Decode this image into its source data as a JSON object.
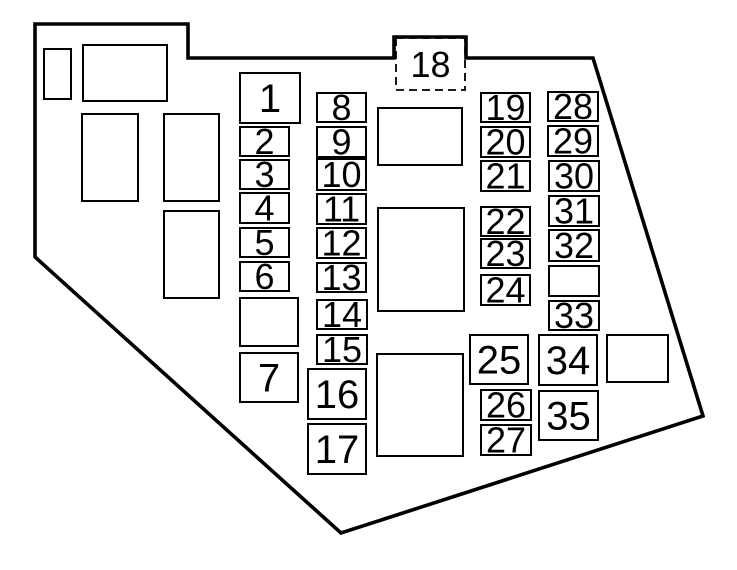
{
  "diagram": {
    "kind": "fuse-box-layout",
    "background": "#ffffff",
    "line_color": "#000000",
    "outline_path": "M35,24 L188,24 L188,58 L394,58 L394,37 L466,37 L466,58 L593,58 L703,416 L341,533 L35,257 Z",
    "dashed_fuse": {
      "label": "18",
      "x": 396,
      "y": 38,
      "w": 69,
      "h": 52
    },
    "fuses": [
      {
        "label": "1",
        "x": 240,
        "y": 73,
        "w": 60,
        "h": 50,
        "big": true
      },
      {
        "label": "2",
        "x": 240,
        "y": 127,
        "w": 49,
        "h": 29,
        "big": false
      },
      {
        "label": "3",
        "x": 240,
        "y": 160,
        "w": 49,
        "h": 29,
        "big": false
      },
      {
        "label": "4",
        "x": 240,
        "y": 193,
        "w": 49,
        "h": 30,
        "big": false
      },
      {
        "label": "5",
        "x": 240,
        "y": 228,
        "w": 49,
        "h": 29,
        "big": false
      },
      {
        "label": "6",
        "x": 240,
        "y": 262,
        "w": 49,
        "h": 29,
        "big": false
      },
      {
        "label": "7",
        "x": 240,
        "y": 353,
        "w": 58,
        "h": 49,
        "big": true
      },
      {
        "label": "8",
        "x": 317,
        "y": 93,
        "w": 49,
        "h": 29,
        "big": false
      },
      {
        "label": "9",
        "x": 317,
        "y": 127,
        "w": 49,
        "h": 30,
        "big": false
      },
      {
        "label": "10",
        "x": 317,
        "y": 159,
        "w": 49,
        "h": 31,
        "big": false
      },
      {
        "label": "11",
        "x": 317,
        "y": 194,
        "w": 49,
        "h": 30,
        "big": false
      },
      {
        "label": "12",
        "x": 317,
        "y": 228,
        "w": 49,
        "h": 30,
        "big": false
      },
      {
        "label": "13",
        "x": 317,
        "y": 263,
        "w": 49,
        "h": 29,
        "big": false
      },
      {
        "label": "14",
        "x": 317,
        "y": 300,
        "w": 50,
        "h": 29,
        "big": false
      },
      {
        "label": "15",
        "x": 317,
        "y": 335,
        "w": 50,
        "h": 29,
        "big": false
      },
      {
        "label": "16",
        "x": 308,
        "y": 369,
        "w": 58,
        "h": 50,
        "big": true
      },
      {
        "label": "17",
        "x": 308,
        "y": 424,
        "w": 58,
        "h": 50,
        "big": true
      },
      {
        "label": "19",
        "x": 481,
        "y": 93,
        "w": 49,
        "h": 29,
        "big": false
      },
      {
        "label": "20",
        "x": 481,
        "y": 127,
        "w": 49,
        "h": 30,
        "big": false
      },
      {
        "label": "21",
        "x": 481,
        "y": 161,
        "w": 49,
        "h": 30,
        "big": false
      },
      {
        "label": "22",
        "x": 481,
        "y": 207,
        "w": 49,
        "h": 29,
        "big": false
      },
      {
        "label": "23",
        "x": 481,
        "y": 239,
        "w": 49,
        "h": 29,
        "big": false
      },
      {
        "label": "24",
        "x": 481,
        "y": 275,
        "w": 49,
        "h": 30,
        "big": false
      },
      {
        "label": "25",
        "x": 470,
        "y": 335,
        "w": 58,
        "h": 49,
        "big": true
      },
      {
        "label": "26",
        "x": 481,
        "y": 390,
        "w": 50,
        "h": 30,
        "big": false
      },
      {
        "label": "27",
        "x": 481,
        "y": 425,
        "w": 50,
        "h": 30,
        "big": false
      },
      {
        "label": "28",
        "x": 548,
        "y": 92,
        "w": 50,
        "h": 29,
        "big": false
      },
      {
        "label": "29",
        "x": 548,
        "y": 126,
        "w": 50,
        "h": 30,
        "big": false
      },
      {
        "label": "30",
        "x": 549,
        "y": 161,
        "w": 50,
        "h": 30,
        "big": false
      },
      {
        "label": "31",
        "x": 549,
        "y": 196,
        "w": 50,
        "h": 30,
        "big": false
      },
      {
        "label": "32",
        "x": 549,
        "y": 230,
        "w": 50,
        "h": 31,
        "big": false
      },
      {
        "label": "33",
        "x": 549,
        "y": 301,
        "w": 50,
        "h": 29,
        "big": false
      },
      {
        "label": "34",
        "x": 539,
        "y": 335,
        "w": 58,
        "h": 50,
        "big": true
      },
      {
        "label": "35",
        "x": 539,
        "y": 391,
        "w": 59,
        "h": 49,
        "big": true
      }
    ],
    "blank_slots": [
      {
        "x": 44,
        "y": 49,
        "w": 27,
        "h": 50
      },
      {
        "x": 83,
        "y": 45,
        "w": 84,
        "h": 56
      },
      {
        "x": 82,
        "y": 114,
        "w": 56,
        "h": 87
      },
      {
        "x": 164,
        "y": 114,
        "w": 55,
        "h": 87
      },
      {
        "x": 164,
        "y": 211,
        "w": 55,
        "h": 87
      },
      {
        "x": 240,
        "y": 298,
        "w": 58,
        "h": 48
      },
      {
        "x": 378,
        "y": 108,
        "w": 84,
        "h": 57
      },
      {
        "x": 378,
        "y": 208,
        "w": 86,
        "h": 103
      },
      {
        "x": 377,
        "y": 354,
        "w": 86,
        "h": 102
      },
      {
        "x": 549,
        "y": 266,
        "w": 50,
        "h": 30
      },
      {
        "x": 607,
        "y": 335,
        "w": 61,
        "h": 47
      }
    ]
  }
}
